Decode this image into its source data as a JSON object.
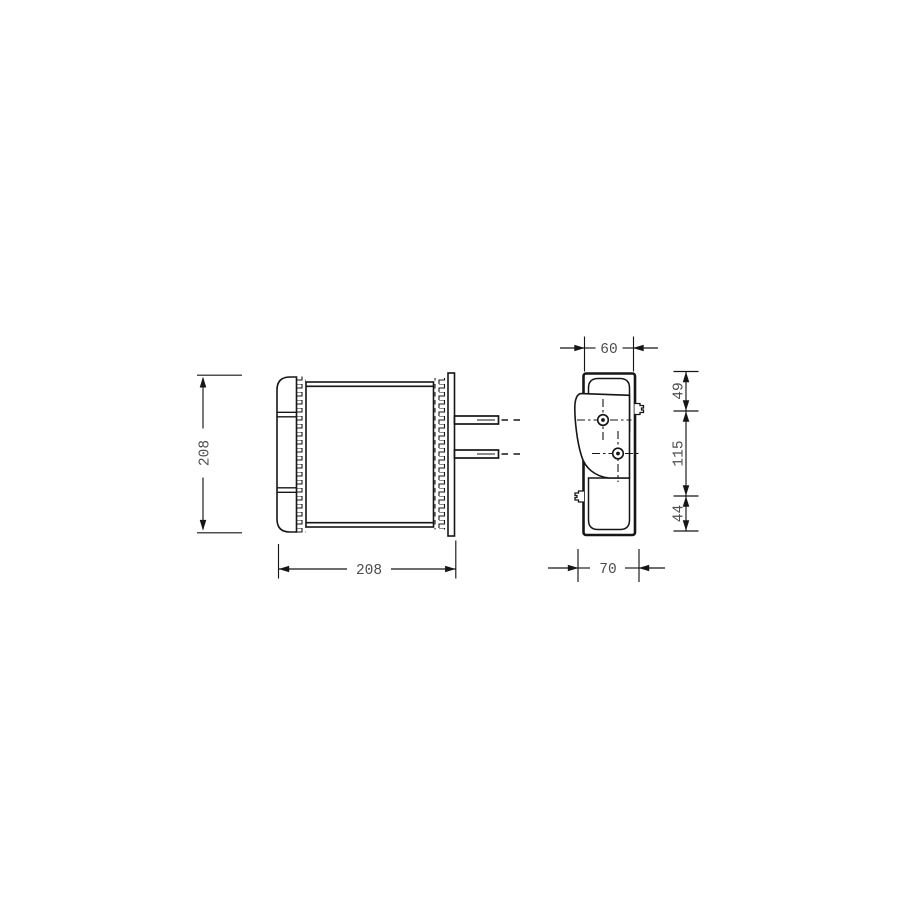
{
  "drawing": {
    "colors": {
      "background": "#ffffff",
      "line": "#161616",
      "dimension_text": "#4d4d4d"
    },
    "dims": {
      "front_height": "208",
      "front_width": "208",
      "side_width_top": "60",
      "side_width_bottom": "70",
      "side_segment_top": "49",
      "side_segment_middle": "115",
      "side_segment_bottom": "44"
    }
  }
}
